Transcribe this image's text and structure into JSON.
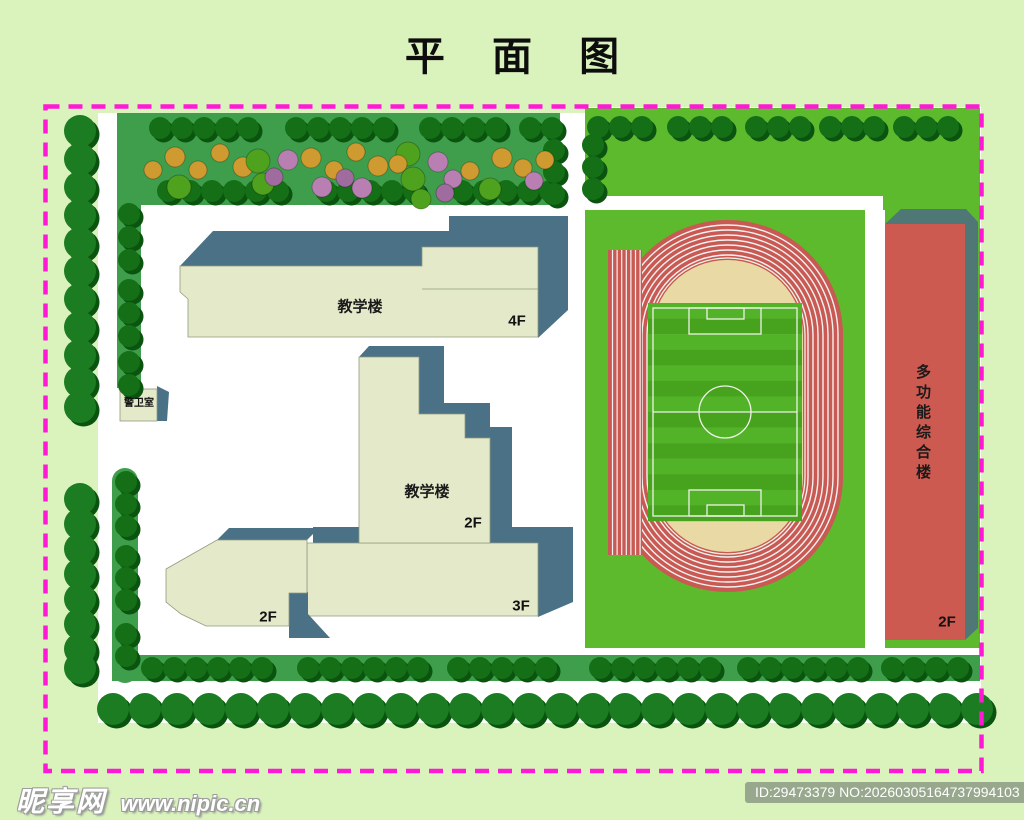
{
  "title": "平 面 图",
  "plan": {
    "buildings": {
      "teaching_top": {
        "label": "教学楼",
        "floor": "4F"
      },
      "teaching_mid": {
        "label": "教学楼",
        "floor": "2F"
      },
      "annex_left": {
        "floor": "2F"
      },
      "annex_bottom": {
        "floor": "3F"
      },
      "guard_room": {
        "label": "警卫室"
      },
      "multi_purpose": {
        "label": "多功能综合楼",
        "floor": "2F"
      }
    }
  },
  "watermark": {
    "brand": "昵享网",
    "url": "www.nipic.cn",
    "badge": "ID:29473379 NO:20260305164737994103"
  },
  "colors": {
    "background": "#daf3bd",
    "border": "#ff18d5",
    "lawn": "#5cba2c",
    "garden": "#3f9e4c",
    "tree_small": "#156f17",
    "tree_big": "#1c7c21",
    "tree_shadow": "#0a5410",
    "building_face": "#e4e9ca",
    "building_shadow": "#4a7186",
    "track_red": "#c95a53",
    "infield_tan": "#e9d9a4",
    "pitch_light": "#52b228",
    "pitch_dark": "#47a21d",
    "multi_face": "#cd5a50",
    "multi_shadow": "#4f7775",
    "flower_gold": "#cf9a2f",
    "flower_green": "#4ea21d",
    "flower_pink": "#b97fb2",
    "flower_violet": "#a06b9e",
    "badge_bg": "#98a88d",
    "white_line": "#f2f2f2"
  }
}
